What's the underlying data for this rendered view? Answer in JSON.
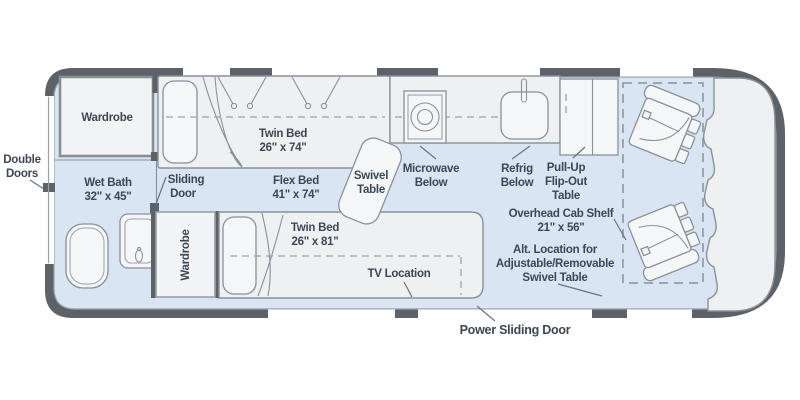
{
  "floorplan": {
    "title": "Camper van floor plan",
    "colors": {
      "wall": "#5d6269",
      "floor": "#d9e5f3",
      "furniture": "#eef0f2",
      "furniture_light": "#f5f6f8",
      "outline": "#8a9199",
      "text": "#3d4754",
      "leader": "#6a7380"
    },
    "labels": {
      "double_doors": [
        "Double",
        "Doors"
      ],
      "wardrobe_rear": "Wardrobe",
      "wet_bath": [
        "Wet Bath",
        "32\" x 45\""
      ],
      "sliding_door": [
        "Sliding",
        "Door"
      ],
      "twin_bed_upper": [
        "Twin Bed",
        "26\" x 74\""
      ],
      "flex_bed": [
        "Flex Bed",
        "41\" x 74\""
      ],
      "swivel_table": [
        "Swivel",
        "Table"
      ],
      "microwave": [
        "Microwave",
        "Below"
      ],
      "refrig": [
        "Refrig",
        "Below"
      ],
      "pull_up_table": [
        "Pull-Up",
        "Flip-Out",
        "Table"
      ],
      "overhead_cab_shelf": [
        "Overhead Cab Shelf",
        "21\" x 56\""
      ],
      "alt_swivel_table": [
        "Alt. Location for",
        "Adjustable/Removable",
        "Swivel Table"
      ],
      "twin_bed_lower": [
        "Twin Bed",
        "26\" x 81\""
      ],
      "tv_location": "TV Location",
      "wardrobe_mid": "Wardrobe",
      "power_sliding_door": "Power Sliding Door"
    }
  }
}
